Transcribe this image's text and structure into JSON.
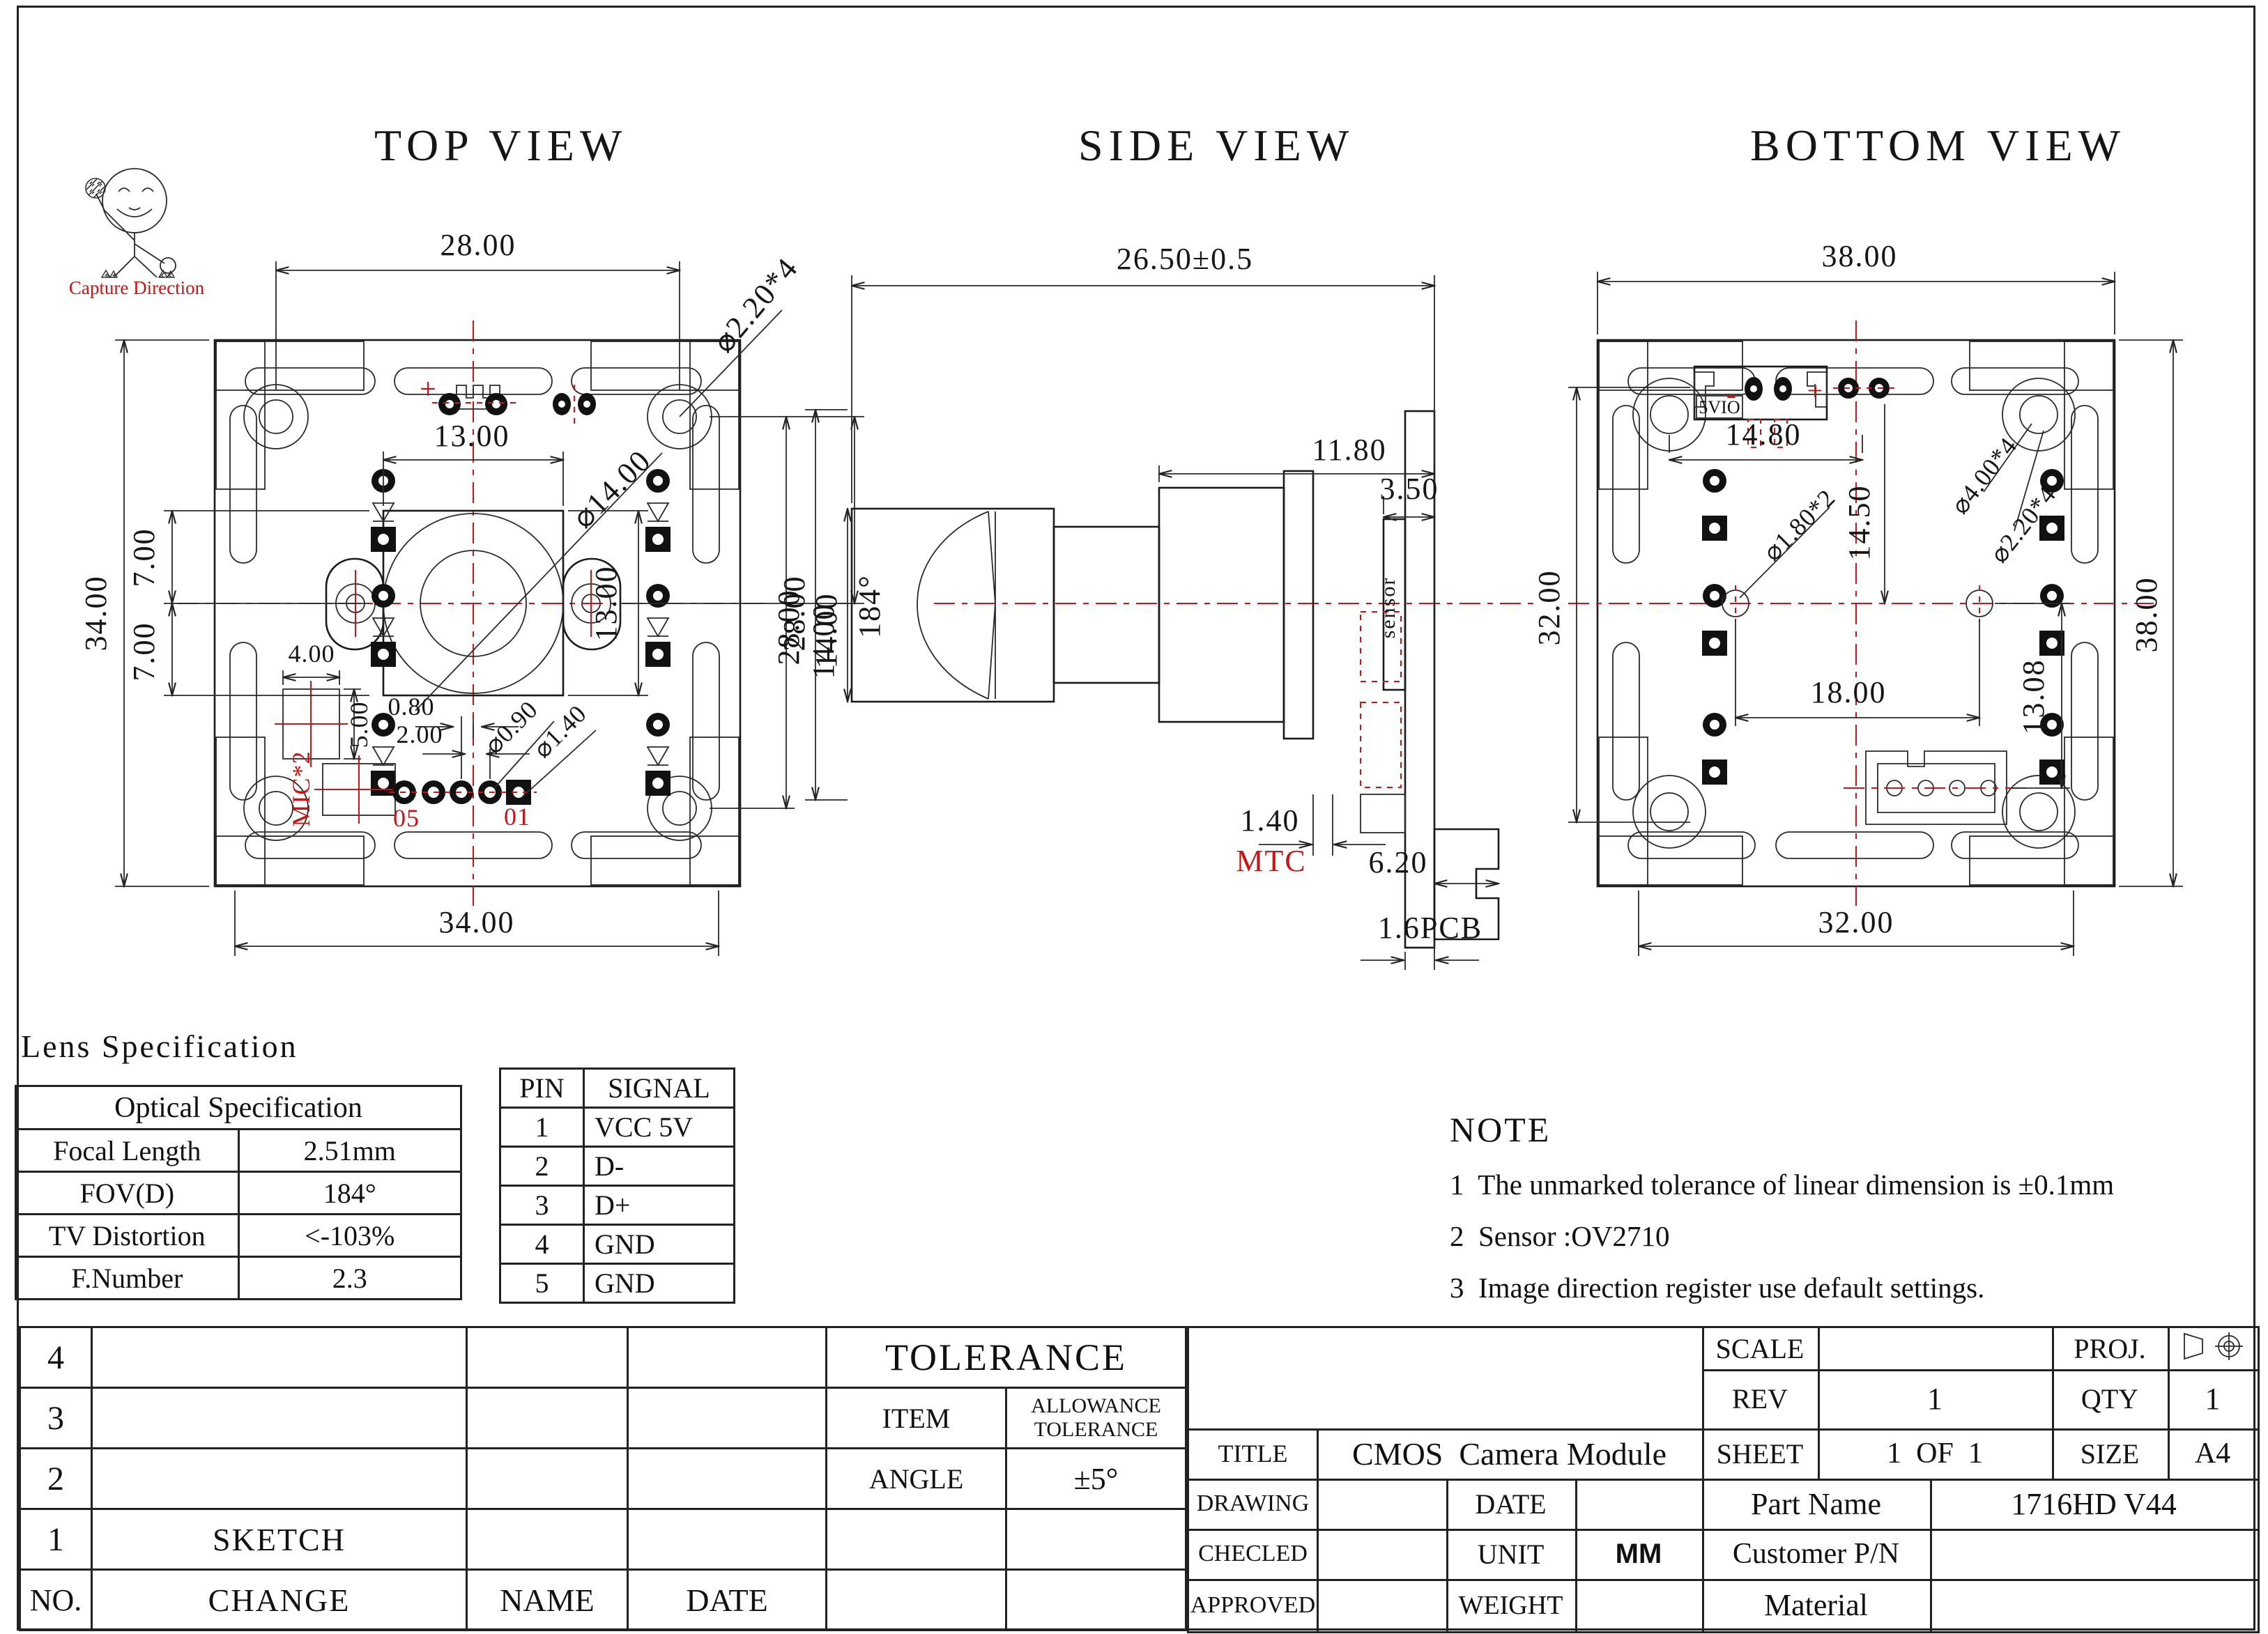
{
  "logo": {
    "caption": "Capture Direction"
  },
  "views": {
    "top": {
      "title": "TOP VIEW",
      "labels": {
        "width_top": "28.00",
        "hole_note": "⌀2.20*4",
        "lens_width": "13.00",
        "lens_dia": "⌀14.00",
        "height_left": "34.00",
        "pitch_a": "7.00",
        "pitch_b": "7.00",
        "mic_w": "4.00",
        "mic_h": "5.00",
        "mic_label": "MIC*2",
        "pad_gap": "0.80",
        "pad_pitch": "2.00",
        "pad_dia": "⌀0.90",
        "pad_dia2": "⌀1.40",
        "pad_first": "05",
        "pad_last": "01",
        "lens_height": "13.00",
        "height_right": "28.00",
        "half_height": "14.00",
        "width_bottom": "34.00",
        "plus_mark": "+"
      }
    },
    "side": {
      "title": "SIDE VIEW",
      "labels": {
        "total_len": "26.50±0.5",
        "len_body": "11.80",
        "len_sensor": "3.50",
        "fov": "184°",
        "h28": "28.00",
        "h14": "14.00",
        "sensor": "sensor",
        "mtc_gap": "1.40",
        "mtc": "MTC",
        "conn_len": "6.20",
        "pcb_t": "1.6PCB"
      }
    },
    "bottom": {
      "title": "BOTTOM VIEW",
      "labels": {
        "width_top": "38.00",
        "conn": "5VIO",
        "minus_mark": "-",
        "plus_mark": "+",
        "conn_w": "14.80",
        "h_center": "14.50",
        "hole_dia": "⌀4.00*4",
        "hole_dia2": "⌀2.20*4",
        "pin_dia": "⌀1.80*2",
        "pin_span": "18.00",
        "conn_off": "13.08",
        "h_left": "32.00",
        "h_right": "38.00",
        "width_bottom": "32.00"
      }
    }
  },
  "lens_spec": {
    "heading": "Lens Specification",
    "table_title": "Optical Specification",
    "rows": [
      [
        "Focal Length",
        "2.51mm"
      ],
      [
        "FOV(D)",
        "184°"
      ],
      [
        "TV Distortion",
        "<-103%"
      ],
      [
        "F.Number",
        "2.3"
      ]
    ]
  },
  "pin_table": {
    "headers": [
      "PIN",
      "SIGNAL"
    ],
    "rows": [
      [
        "1",
        "VCC 5V"
      ],
      [
        "2",
        "D-"
      ],
      [
        "3",
        "D+"
      ],
      [
        "4",
        "GND"
      ],
      [
        "5",
        "GND"
      ]
    ]
  },
  "note": {
    "heading": "NOTE",
    "items": [
      "1  The unmarked tolerance of linear dimension is ±0.1mm",
      "2  Sensor :OV2710",
      "3  Image direction register use default settings."
    ]
  },
  "title_block": {
    "left": {
      "row_nums": [
        "4",
        "3",
        "2",
        "1",
        "NO."
      ],
      "tolerance_title": "TOLERANCE",
      "item_label": "ITEM",
      "allowance_1": "ALLOWANCE",
      "allowance_2": "TOLERANCE",
      "angle_label": "ANGLE",
      "angle_value": "±5°",
      "sketch": "SKETCH",
      "change": "CHANGE",
      "name": "NAME",
      "date": "DATE"
    },
    "right": {
      "scale_label": "SCALE",
      "proj_label": "PROJ.",
      "rev_label": "REV",
      "rev_value": "1",
      "qty_label": "QTY",
      "qty_value": "1",
      "title_label": "TITLE",
      "title_value": "CMOS  Camera Module",
      "sheet_label": "SHEET",
      "sheet_value": "1  OF  1",
      "size_label": "SIZE",
      "size_value": "A4",
      "drawing_label": "DRAWING",
      "date_label": "DATE",
      "part_name_label": "Part Name",
      "part_name_value": "1716HD V44",
      "checked_label": "CHECLED",
      "unit_label": "UNIT",
      "unit_value": "MM",
      "customer_label": "Customer P/N",
      "approved_label": "APPROVED",
      "weight_label": "WEIGHT",
      "material_label": "Material"
    }
  }
}
